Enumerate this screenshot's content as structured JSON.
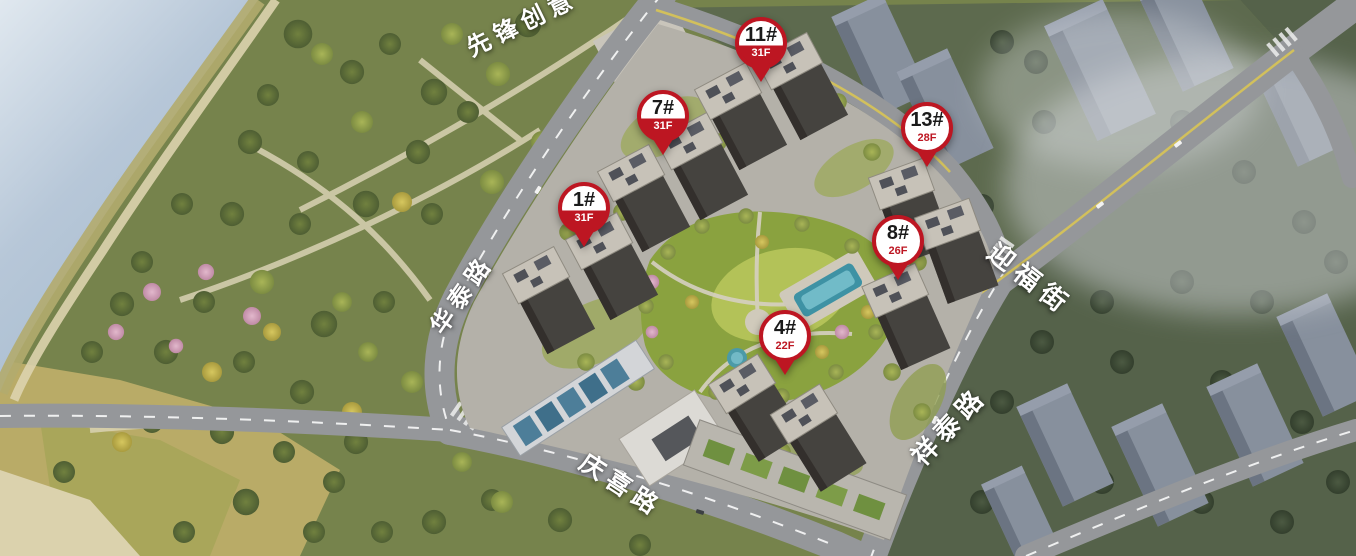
{
  "markers": [
    {
      "number": "1#",
      "floors": "31F",
      "style": "band"
    },
    {
      "number": "4#",
      "floors": "22F",
      "style": "plain"
    },
    {
      "number": "7#",
      "floors": "31F",
      "style": "band"
    },
    {
      "number": "8#",
      "floors": "26F",
      "style": "plain"
    },
    {
      "number": "11#",
      "floors": "31F",
      "style": "band"
    },
    {
      "number": "13#",
      "floors": "28F",
      "style": "plain"
    }
  ],
  "street_labels": [
    {
      "name": "先锋创意"
    },
    {
      "name": "华泰路"
    },
    {
      "name": "迎福街"
    },
    {
      "name": "祥泰路"
    },
    {
      "name": "庆喜路"
    }
  ],
  "colors": {
    "marker_red": "#bd1622",
    "marker_number": "#1a1a1a",
    "label_white": "#ffffff",
    "water": "#b7c7d8",
    "park_green": "#76834c",
    "road_gray": "#95979a",
    "site_ground": "#b4b1a9",
    "courtyard_green": "#8aa23f",
    "pool_blue": "#3e92a4",
    "city_gray": "#87909d"
  }
}
